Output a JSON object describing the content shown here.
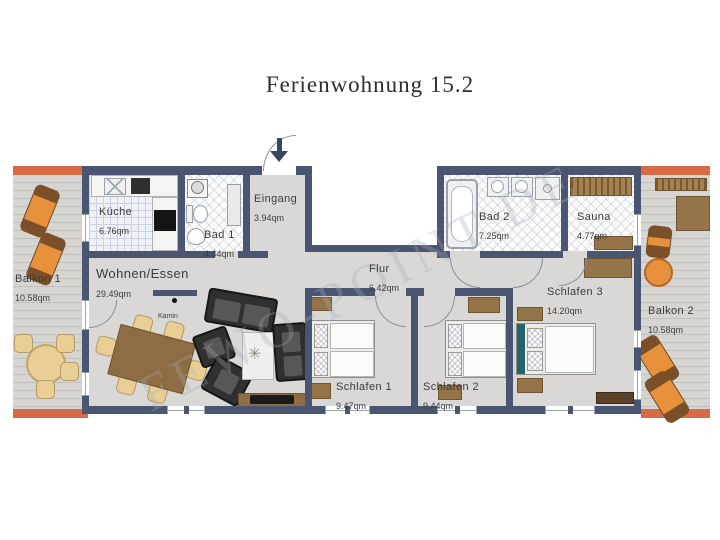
{
  "title": "Ferienwohnung 15.2",
  "watermark": "FEWO-POINT.DE",
  "rooms": {
    "balkon1": {
      "name": "Balkon 1",
      "area": "10.58qm"
    },
    "kueche": {
      "name": "Küche",
      "area": "6.76qm"
    },
    "bad1": {
      "name": "Bad 1",
      "area": "4.44qm"
    },
    "eingang": {
      "name": "Eingang",
      "area": "3.94qm"
    },
    "bad2": {
      "name": "Bad 2",
      "area": "7.25qm"
    },
    "sauna": {
      "name": "Sauna",
      "area": "4.77qm"
    },
    "wohnen_essen": {
      "name": "Wohnen/Essen",
      "area": "29.49qm"
    },
    "flur": {
      "name": "Flur",
      "area": "6.42qm"
    },
    "schlafen1": {
      "name": "Schlafen 1",
      "area": "9.47qm"
    },
    "schlafen2": {
      "name": "Schlafen 2",
      "area": "9.44qm"
    },
    "schlafen3": {
      "name": "Schlafen 3",
      "area": "14.20qm"
    },
    "balkon2": {
      "name": "Balkon 2",
      "area": "10.58qm"
    }
  },
  "annotations": {
    "kamin": "Kamin"
  },
  "colors": {
    "wall": "#4a5671",
    "floor": "#d9d8d6",
    "balcony_edge": "#d96a47",
    "wood": "#96744a",
    "lounger_orange": "#e8913c",
    "bed_headboard_teal": "#23656d"
  }
}
